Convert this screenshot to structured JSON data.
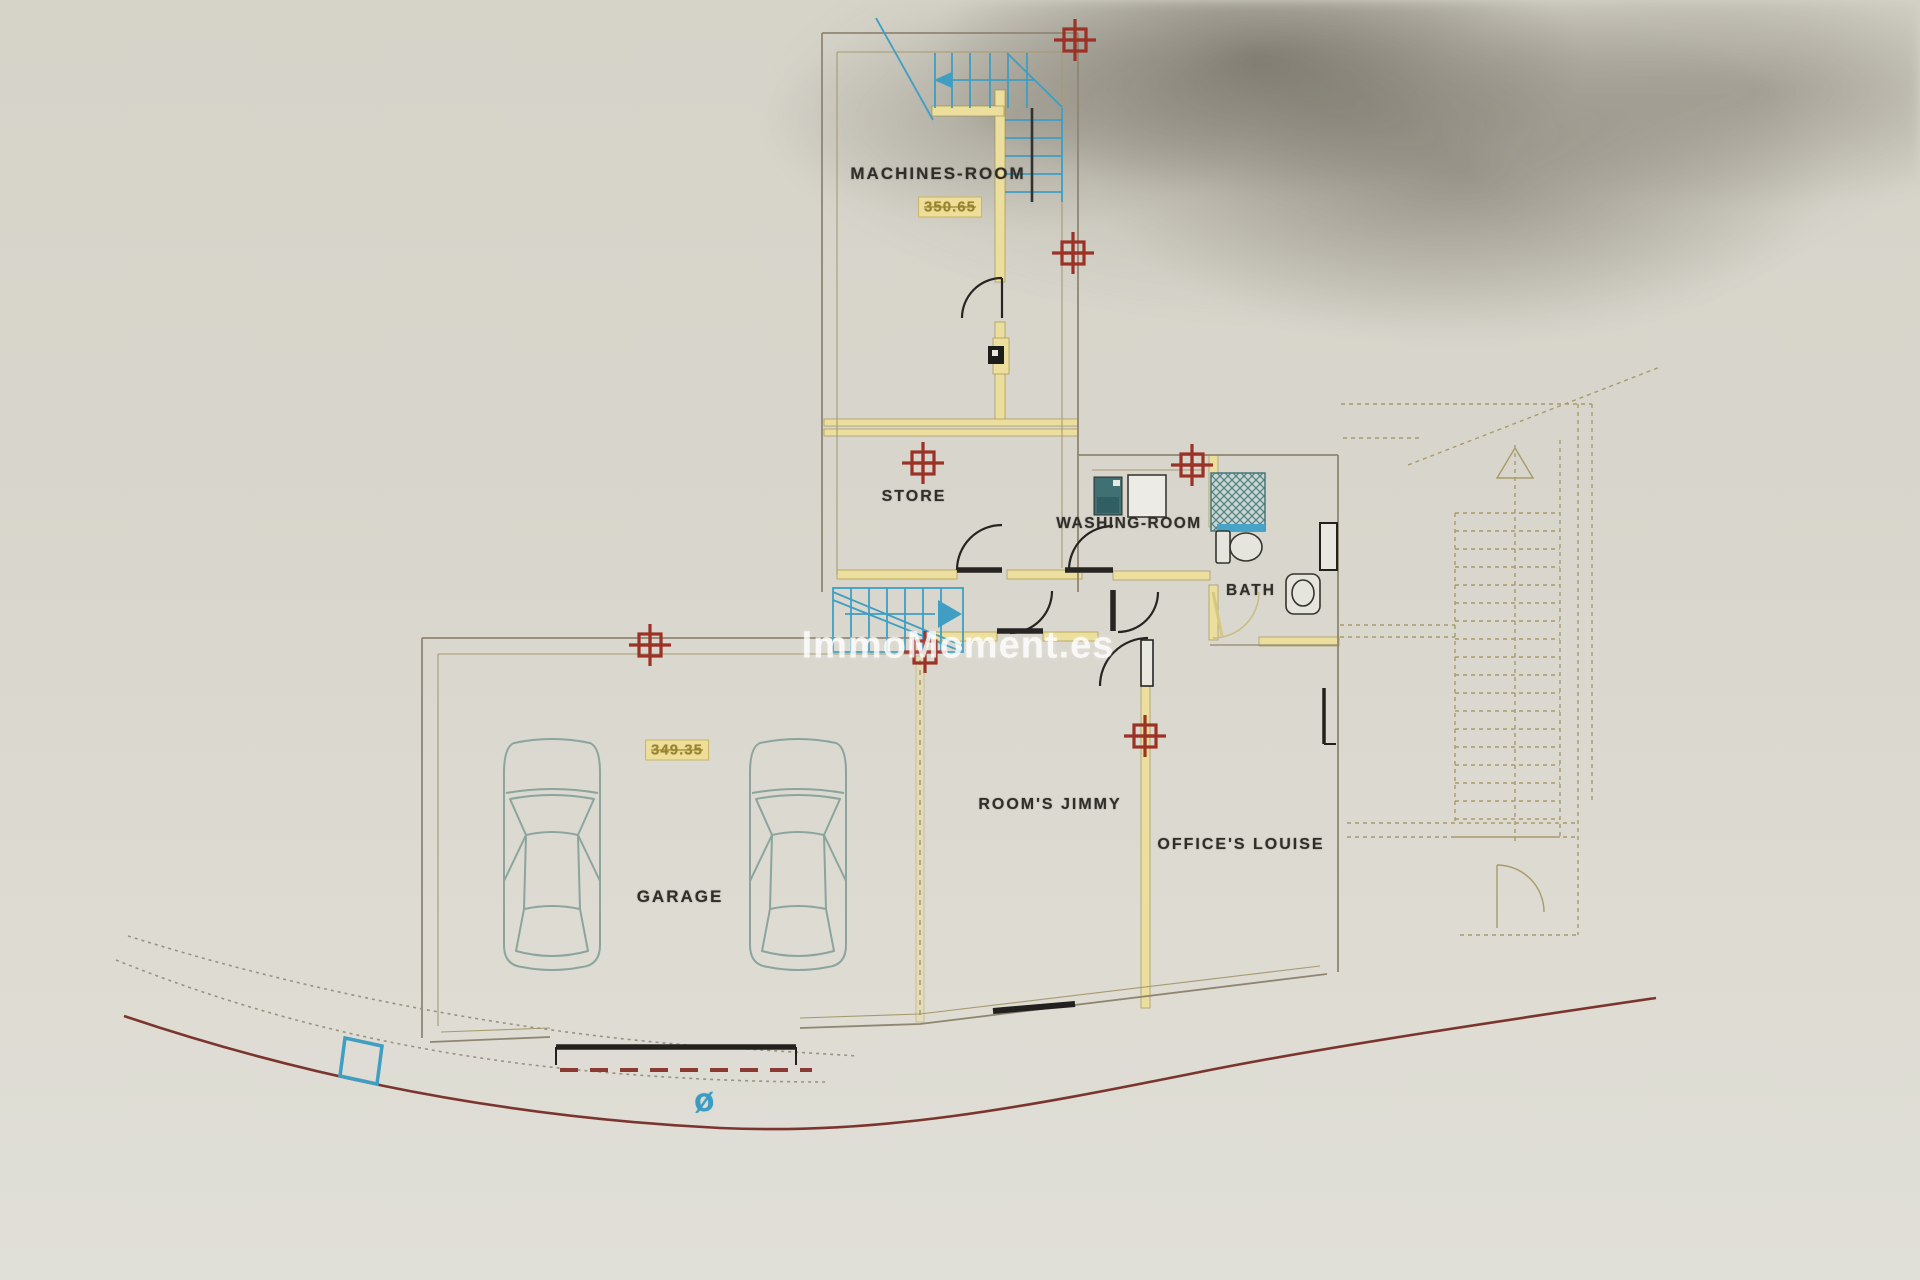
{
  "plan": {
    "watermark": "ImmoMoment.es",
    "rooms": [
      {
        "name": "machines-room",
        "label": "MACHINES-ROOM",
        "elevation": "350.65"
      },
      {
        "name": "store",
        "label": "STORE"
      },
      {
        "name": "washing-room",
        "label": "WASHING-ROOM"
      },
      {
        "name": "bath",
        "label": "BATH"
      },
      {
        "name": "rooms-jimmy",
        "label": "ROOM'S JIMMY"
      },
      {
        "name": "offices-louise",
        "label": "OFFICE'S LOUISE"
      },
      {
        "name": "garage",
        "label": "GARAGE",
        "elevation": "349.35"
      }
    ],
    "symbols": {
      "diameter": "ø"
    },
    "survey_markers": {
      "count": 7,
      "positions": [
        [
          1075,
          40
        ],
        [
          1073,
          253
        ],
        [
          923,
          463
        ],
        [
          1192,
          465
        ],
        [
          650,
          645
        ],
        [
          925,
          652
        ],
        [
          1145,
          736
        ]
      ]
    },
    "colors": {
      "paper": "#d9d7cd",
      "wall_line": "#8f8672",
      "wall_highlight": "#ecdf9e",
      "stairs_blue": "#3f9ec2",
      "marker_red": "#9c3126",
      "road_red": "#7b352e",
      "driveway_gray": "#999482",
      "fixture_teal": "#4e8184",
      "car_outline": "#8ba49e",
      "ink": "#2f2e29",
      "watermark_white": "rgba(255,255,255,0.78)"
    }
  }
}
